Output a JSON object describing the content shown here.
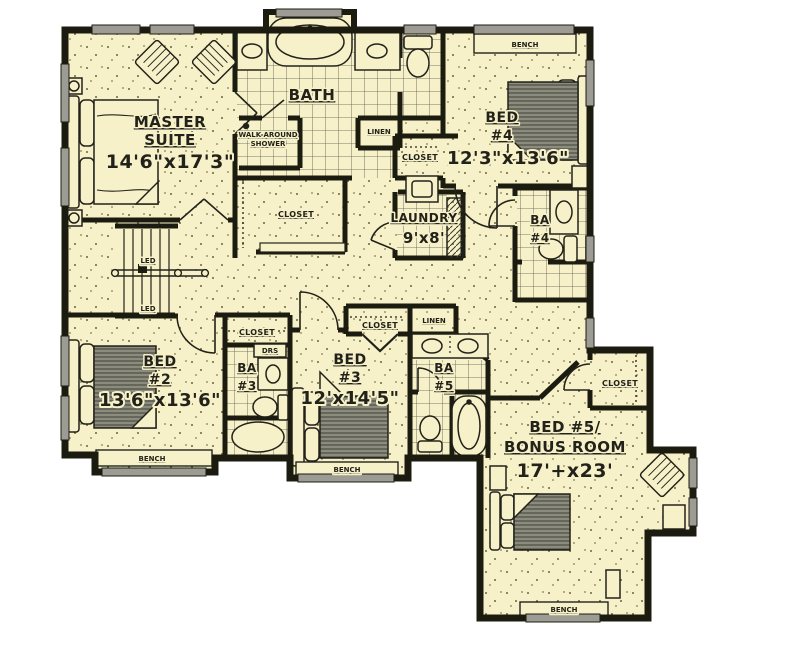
{
  "plan_type": "second-floor house plan",
  "colors": {
    "floor": "#f6f1c9",
    "wall": "#1c1b10",
    "window_gray": "#9c9c94",
    "tile_line": "#55524a",
    "furniture_gray": "#8e8e82"
  },
  "rooms": {
    "master": {
      "name1": "MASTER",
      "name2": "SUITE",
      "dims": "14'6\"x17'3\""
    },
    "bath": {
      "name": "BATH"
    },
    "shower": {
      "name1": "WALK-AROUND",
      "name2": "SHOWER"
    },
    "master_closet": {
      "name": "CLOSET"
    },
    "bed4": {
      "name1": "BED",
      "name2": "#4",
      "dims": "12'3\"x13'6\""
    },
    "bed4_closet": {
      "name": "CLOSET"
    },
    "bath_linen": {
      "name": "LINEN"
    },
    "laundry": {
      "name": "LAUNDRY",
      "dims": "9'x8'"
    },
    "ba4": {
      "name1": "BA",
      "name2": "#4"
    },
    "bed2": {
      "name1": "BED",
      "name2": "#2",
      "dims": "13'6\"x13'6\""
    },
    "bed2_closet": {
      "name": "CLOSET"
    },
    "ba3": {
      "name1": "BA",
      "name2": "#3"
    },
    "ba3_drawers": {
      "name": "DRS"
    },
    "bed3": {
      "name1": "BED",
      "name2": "#3",
      "dims": "12'x14'5\""
    },
    "bed3_closet": {
      "name": "CLOSET"
    },
    "hall_linen": {
      "name": "LINEN"
    },
    "ba5": {
      "name1": "BA",
      "name2": "#5"
    },
    "bonus": {
      "name1": "BED #5/",
      "name2": "BONUS ROOM",
      "dims": "17'+x23'"
    },
    "bonus_closet": {
      "name": "CLOSET"
    }
  },
  "labels": {
    "bench": "BENCH",
    "stair_led": "LED"
  }
}
